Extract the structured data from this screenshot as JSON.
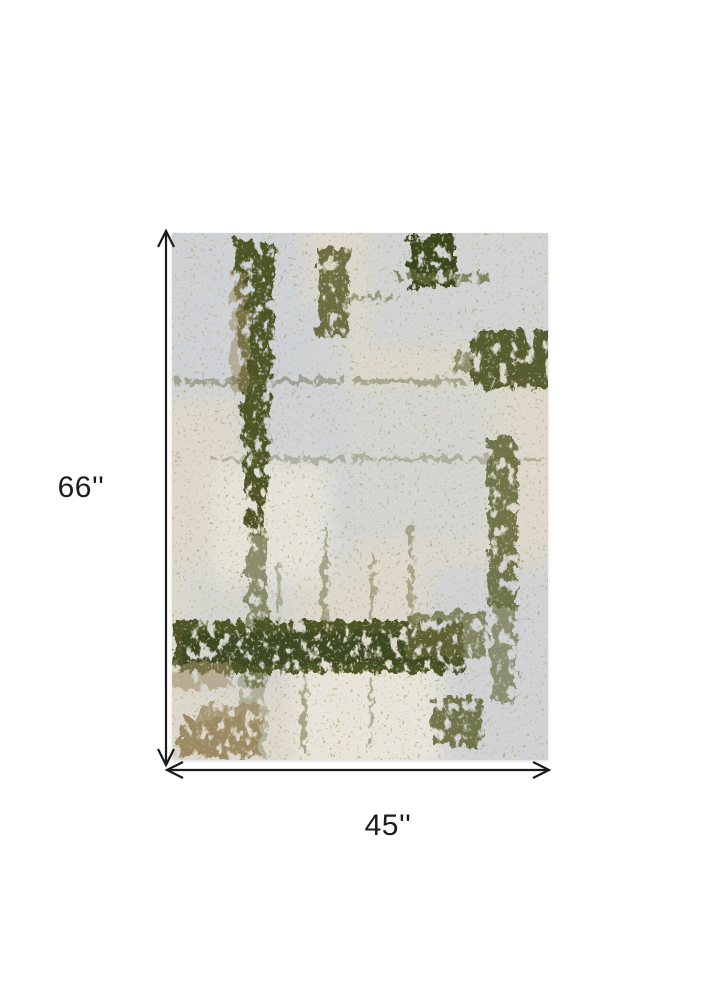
{
  "page": {
    "background": "#ffffff"
  },
  "diagram": {
    "height_label": "66''",
    "width_label": "45''",
    "arrow_color": "#1b1b1b"
  },
  "rug": {
    "description": "abstract distressed olive green and ivory area rug",
    "colors": {
      "ivory": "#ddd8cb",
      "ivory_light": "#eae6da",
      "gray": "#cdd1d6",
      "olive": "#65693a",
      "olive_dark": "#4d5527",
      "green_deep": "#3b461f",
      "tan": "#9c8a63"
    }
  }
}
